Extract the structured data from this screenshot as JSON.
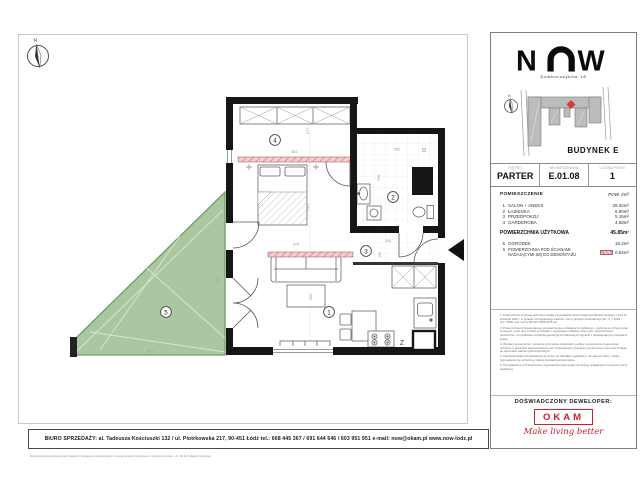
{
  "plan": {
    "compass_label": "N",
    "kitchen_z": "Z",
    "room_numbers": {
      "salon": "1",
      "lazienka": "2",
      "przedpokoj": "3",
      "garderoba": "4",
      "ogrodek": "5"
    },
    "dims": {
      "garderoba_width": "384",
      "garderoba_depth": "177",
      "bath_width": "252",
      "bath_depth": "296",
      "bed_depth": "297",
      "salon_width": "378",
      "salon_depth": "306",
      "garden_depth": "554",
      "garden_width": "497",
      "hall_width": "265",
      "hall_depth": "196"
    },
    "colors": {
      "garden": "#a9c8a1",
      "garden_border": "#6f9e6a",
      "wall": "#161616",
      "demolish_fill": "#f5cdd0",
      "demolish_stroke": "#b4646b"
    }
  },
  "panel": {
    "logo": {
      "n": "N",
      "w": "W",
      "brand": "NOW",
      "subtitle": "Dowborczyków 18"
    },
    "sitemap": {
      "building_label": "BUDYNEK E",
      "compass_label": "N"
    },
    "info": {
      "col1_label": "PIĘTRO",
      "col1_value": "PARTER",
      "col2_label": "NR MIESZKANIA",
      "col2_value": "E.01.08",
      "col3_label": "LICZBA POKOI",
      "col3_value": "1"
    },
    "rooms_table": {
      "header_name": "POMIESZCZENIE",
      "header_area": "POW. /m²/",
      "rows": [
        {
          "no": "1",
          "name": "SALON + ANEKS",
          "area": "29.32m²"
        },
        {
          "no": "2",
          "name": "ŁAZIENKA",
          "area": "6.80m²"
        },
        {
          "no": "3",
          "name": "PRZEDPOKÓJ",
          "area": "5.15m²"
        },
        {
          "no": "4",
          "name": "GARDEROBA",
          "area": "4.58m²"
        }
      ],
      "total_label": "POWIERZCHNIA UŻYTKOWA",
      "total_value": "45.85m²",
      "extra5": {
        "no": "5",
        "name": "OGRÓDEK",
        "area": "15.2m²"
      },
      "extra6": {
        "no": "6",
        "name_line1": "POWIERZCHNIA POD ŚCIANAMI",
        "name_line2": "NADAJĄCYMI SIĘ DO DEMONTAŻU",
        "area": "0.54m²"
      }
    },
    "legal": {
      "items": [
        "1. Powierzchnia użytkowa obliczona została na podstawie Rozporządzenia Ministra Rozwoju z dnia 11 września 2020 r. w sprawie szczegółowego zakresu i formy projektu budowlanego (Dz. U. z 2020 r. poz. 1609) oraz normy PN-ISO 9836:2015-12.",
        "2. Powierzchnia użytkowa danego pomieszczenia o charakterze użytkowym, mierzona po obrysie ścian surowych, może ulec zmianie w związku z wykonaniem okładzin ściennych i wykończeniem powierzchni, na podstawie pomiarów geodezyjnych dokonanych zgodnie z obowiązującymi przepisami prawa.",
        "3. Wymiary pomieszczeń, tolerancje przyrostów tynkarskich, podłóg i wykończenia mogą ulegać różnicom w granicach dopuszczalnych norm budowlanych; wysokość pomieszczeń może ulec zmianie po wykonaniu warstw wykończeniowych.",
        "4. Aranżacja lokalu przedstawiona na rzucie ma charakter poglądowy i nie stanowi oferty; meble i wyposażenie nie wchodzą w zakres standardu wykończenia.",
        "5. Przedstawione rozmieszczenie i wyposażenie pełni wyłącznie funkcję poglądową i nie stanowi oferty handlowej."
      ]
    },
    "developer": {
      "label": "DOŚWIADCZONY DEWELOPER:",
      "logo_text": "OKAM",
      "tagline": "Make living better"
    }
  },
  "footer": {
    "sales": "BIURO SPRZEDAŻY: al. Tadeusza Kościuszki 132 / ul. Piotrkowska 217, 90-451 Łódź tel.: 668 445 367 / 691 644 646 / 603 951 951 e-mail: now@okam.pl www.now-lodz.pl",
    "disclaimer": "Niniejsza karta mieszkania ma charakter informacyjno-marketingowy i nie stanowi oferty handlowej w rozumieniu prawa – Art. 66 §1 Kodeksu Cywilnego."
  }
}
